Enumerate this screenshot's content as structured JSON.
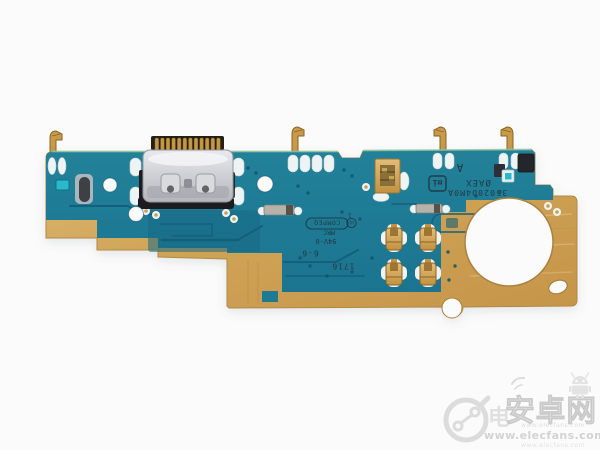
{
  "photo": {
    "background": "#FBFBFB",
    "alt": "USB Type-C charging port flex PCB"
  },
  "board": {
    "colors": {
      "solder_mask_teal": "#1E7E97",
      "copper_gold": "#C99F58",
      "pad_white": "#EEF3F4",
      "connector_silver": "#C9CBCE",
      "connector_black": "#1B1B1F",
      "component_cyan": "#2AB9CC"
    },
    "silkscreen": {
      "corner_letter": "A",
      "vendor_code": "ØAEX",
      "mi_logo": "mi",
      "part_number": "35020D4M0A",
      "pin1": "1",
      "ul_mark": "UL",
      "manufacturer_stamp": "COMPEQ",
      "mrc": "MRC",
      "flammability_rating": "94V-0",
      "panel_code": "6-6",
      "date_code": "1716"
    }
  },
  "watermark": {
    "color": "#DCDCDC",
    "overlap_char": "电",
    "site_name": "安卓网",
    "url": "www.elecfans.com"
  }
}
